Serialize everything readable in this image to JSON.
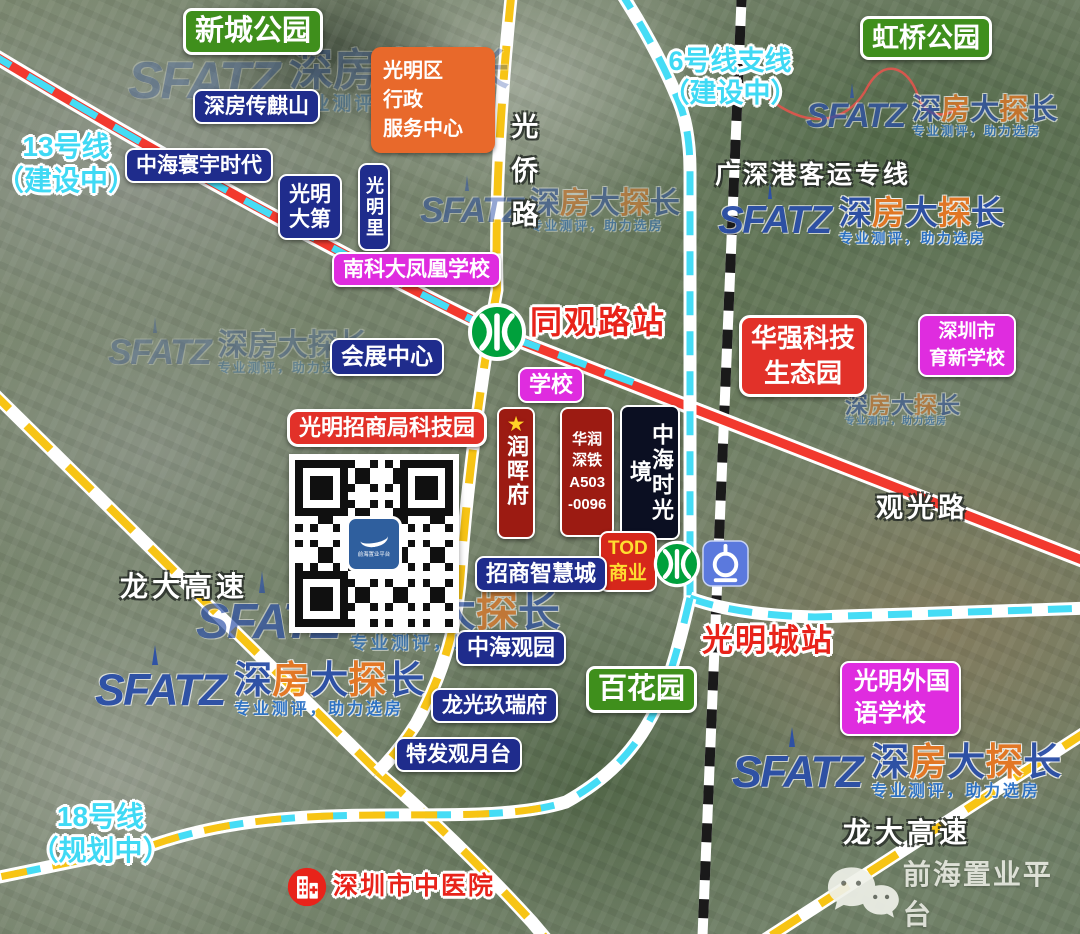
{
  "canvas": {
    "width": 1080,
    "height": 934
  },
  "parks": {
    "xincheng": "新城公园",
    "hongqiao": "虹桥公园",
    "baihua": "百花园"
  },
  "transit": {
    "line13": "13号线\n（建设中）",
    "line6": "6号线支线\n（建设中）",
    "line18": "18号线\n（规划中）",
    "intercity": "广深港客运专线",
    "station_tongguan": "同观路站",
    "station_guangmingcheng": "光明城站"
  },
  "roads": {
    "guangqiao": "光侨路",
    "guanguang": "观光路",
    "longda": "龙大高速"
  },
  "places": {
    "gov_center": "光明区\n行政\n服务中心",
    "chuanqishan": "深房传麒山",
    "huanyu": "中海寰宇时代",
    "dadi": "光明\n大第",
    "guangmingli": "光明里",
    "nankeda_school": "南科大凤凰学校",
    "convention": "会展中心",
    "school": "学校",
    "huaqiang_park": "华强科技\n生态园",
    "yuxin_school": "深圳市\n育新学校",
    "zhaoshang_tech_park": "光明招商局科技园",
    "runhui_star": "★",
    "runhui_mansion": "润晖府",
    "huarun_plot": "华润\n深铁\nA503\n-0096",
    "zhonghai_time": "中海时光境",
    "tod": "TOD\n商业",
    "zhaoshang_smart_city": "招商智慧城",
    "zhonghai_guanyuan": "中海观园",
    "longguang_jiurui": "龙光玖瑞府",
    "tefa_guanyue": "特发观月台",
    "foreign_school": "光明外国\n语学校",
    "hospital": "深圳市中医院"
  },
  "watermark": {
    "logo": "SFATZ",
    "brand_chars": [
      "深",
      "房",
      "大",
      "探",
      "长"
    ],
    "tagline": "专业测评，助力选房",
    "wechat_brand": "前海置业平台",
    "qr_logo_text": "前海置业平台"
  },
  "colors": {
    "navy_box": "#1F2C8C",
    "green_box": "#3F8F1C",
    "orange_box": "#E8692B",
    "magenta_box": "#DF2CDF",
    "red_box": "#E23129",
    "dark_red_box": "#9C1B12",
    "black_box": "#0B0F22",
    "station_text": "#E8231A",
    "cyan_line": "#45DCF5",
    "yellow_road": "#F7C415",
    "red_line": "#F2392E",
    "metro_green": "#00A03C",
    "rail_blue": "#5B79DD",
    "tod_text": "#FFDD30"
  }
}
